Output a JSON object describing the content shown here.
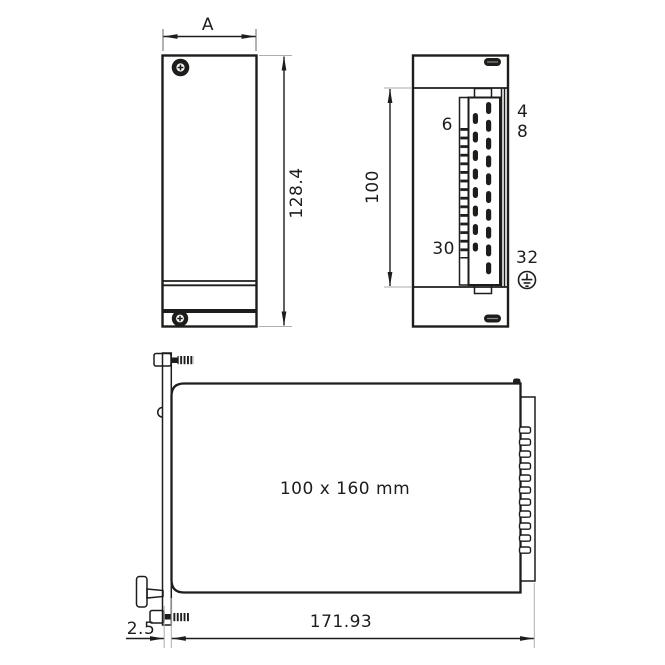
{
  "drawing_title": "Eurocard plug-in module dimension drawing",
  "front_view": {
    "width_dim_label": "A",
    "height_dim_label": "128.4"
  },
  "rear_view": {
    "height_dim_label": "100",
    "connector_pin_label_top_left": "6",
    "connector_pin_label_bottom_left": "30",
    "connector_pin_label_top_right_row1": "4",
    "connector_pin_label_top_right_row2": "8",
    "connector_pin_label_bottom_right": "32",
    "ground_symbol": "earth-ground"
  },
  "side_view": {
    "board_size_label": "100 x 160 mm",
    "length_dim_label": "171.93",
    "panel_offset_dim_label": "2.5"
  },
  "colors": {
    "line": "#1d1d1b",
    "extension_line": "#a9aeae",
    "background": "#ffffff"
  }
}
